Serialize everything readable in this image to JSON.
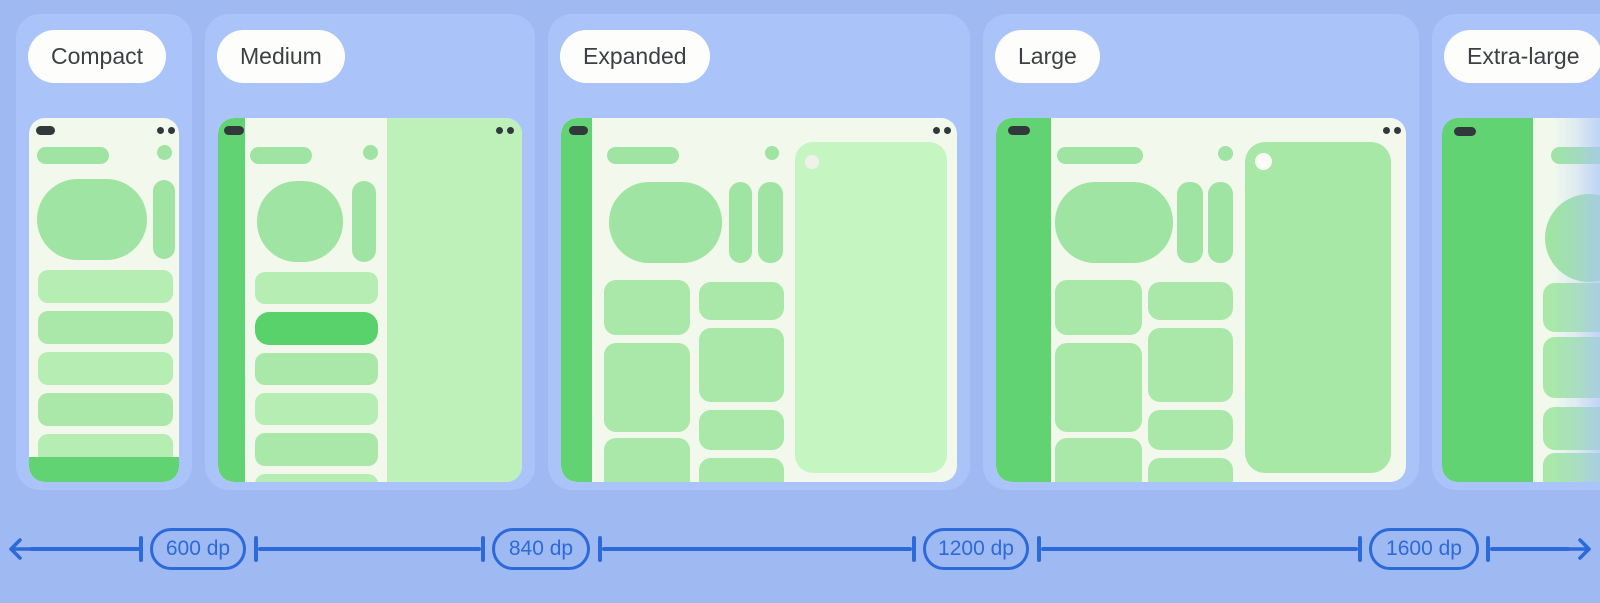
{
  "size_classes": [
    {
      "label": "Compact"
    },
    {
      "label": "Medium"
    },
    {
      "label": "Expanded"
    },
    {
      "label": "Large"
    },
    {
      "label": "Extra-large"
    }
  ],
  "ruler": {
    "breakpoints": [
      {
        "label": "600 dp"
      },
      {
        "label": "840 dp"
      },
      {
        "label": "1200 dp"
      },
      {
        "label": "1600 dp"
      }
    ]
  },
  "colors": {
    "pageBg": "#9FB9F2",
    "panelBg": "#AAC4FA",
    "labelBg": "#FDFDFC",
    "labelText": "#3C4043",
    "deviceBody": "#F2F9EC",
    "dark": "#32393D",
    "mint": "#9FE4A2",
    "mintItem": "#A9E8A8",
    "mintItemLight": "#B5EDB2",
    "green": "#61D373",
    "selected": "#59D26C",
    "paneMedium": "#BDF1B9",
    "paneExpanded": "#C5F5C0",
    "paneLarge": "#A8E8A7",
    "cutoutExpanded": "#EFF1EA",
    "cutoutLarge": "#FBFCF7",
    "rulerBlue": "#2D6AD9"
  }
}
